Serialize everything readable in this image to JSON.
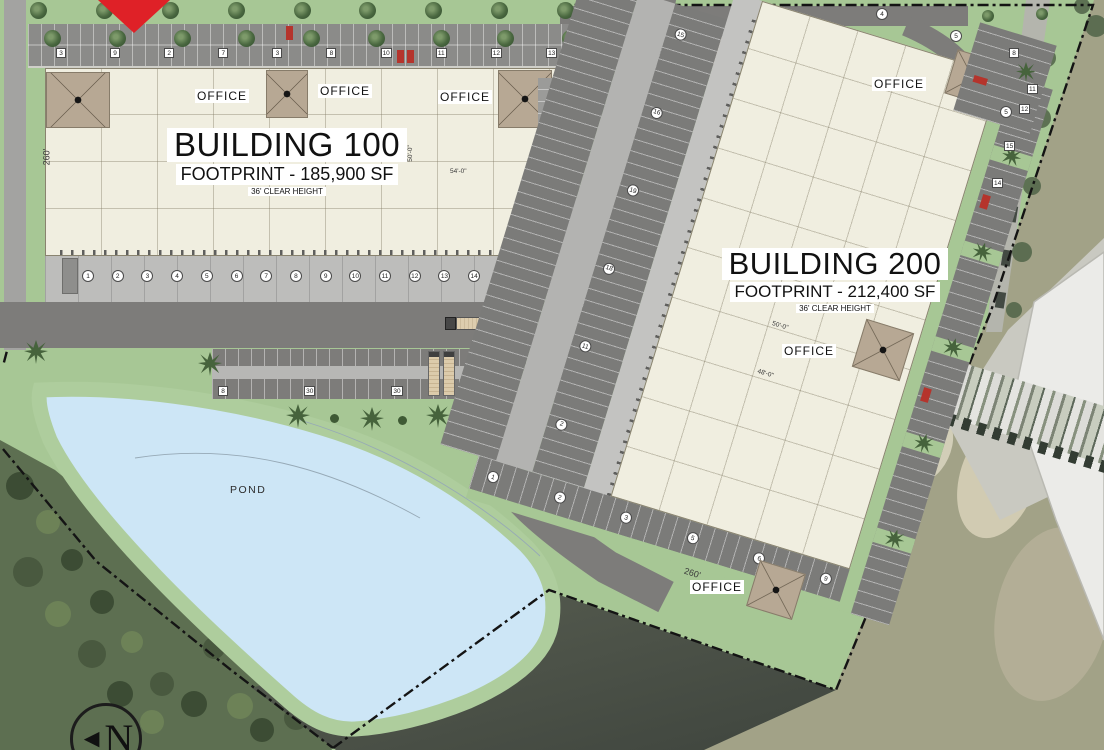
{
  "plan": {
    "building100": {
      "name": "BUILDING 100",
      "footprint": "FOOTPRINT - 185,900 SF",
      "clear_height": "36' CLEAR HEIGHT",
      "side_dimension": "260'",
      "bay_dim_h": "54'-0\"",
      "bay_dim_v": "50'-0\"",
      "office_label_1": "OFFICE",
      "office_label_2": "OFFICE",
      "office_label_3": "OFFICE",
      "dock_numbers": [
        "1",
        "2",
        "3",
        "4",
        "5",
        "6",
        "7",
        "8",
        "9",
        "10",
        "11",
        "12",
        "13",
        "14",
        "15"
      ],
      "parking_badges": [
        "3",
        "9",
        "2",
        "7",
        "3",
        "8",
        "10",
        "11",
        "12",
        "13",
        "15",
        "16"
      ],
      "trailer_badges": [
        "8",
        "30",
        "30",
        "33"
      ]
    },
    "building200": {
      "name": "BUILDING 200",
      "footprint": "FOOTPRINT - 212,400 SF",
      "clear_height": "36' CLEAR HEIGHT",
      "side_dimension": "260'",
      "bay_dim_a": "50'-0\"",
      "bay_dim_b": "48'-0\"",
      "office_label_1": "OFFICE",
      "office_label_2": "OFFICE",
      "office_label_3": "OFFICE",
      "court_badges": [
        "15",
        "16",
        "19",
        "18",
        "11",
        "2"
      ],
      "parking_badges": [
        "8",
        "11",
        "12",
        "15",
        "14"
      ],
      "south_badges": [
        "1",
        "2",
        "3",
        "5",
        "6",
        "9"
      ],
      "entry_badges": [
        "4",
        "5",
        "5"
      ]
    },
    "corridor": {
      "badges": [
        "2",
        "3",
        "2",
        "3",
        "15",
        "22"
      ]
    },
    "pond_label": "POND",
    "north_label": "N"
  },
  "colors": {
    "accent_red": "#df2127",
    "pond_blue": "#cde6f6",
    "building_cream": "#f0eee0",
    "landscape_green": "#a7c795",
    "pavement_gray": "#7d7c7a"
  }
}
